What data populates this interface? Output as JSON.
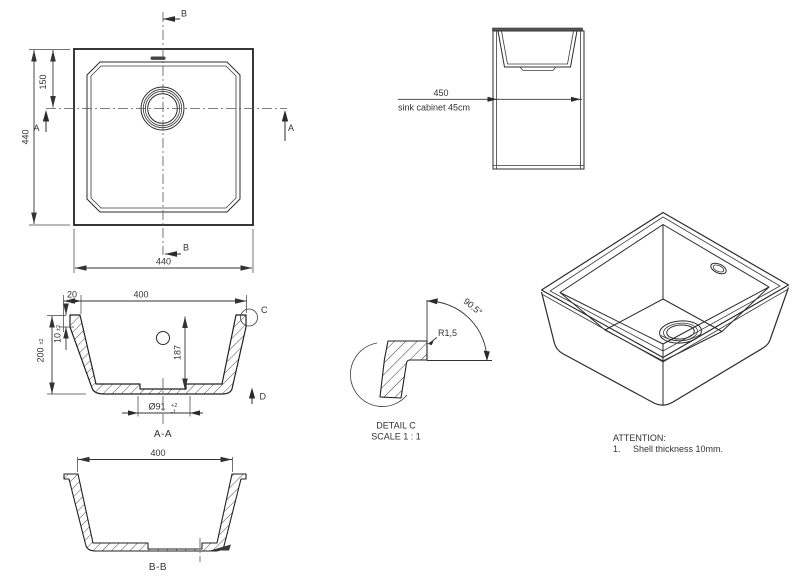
{
  "colors": {
    "line": "#2b2b2b",
    "text": "#333333",
    "background": "#ffffff"
  },
  "plan": {
    "dim_height": "440",
    "dim_drain_offset": "150",
    "dim_width": "440",
    "section_a": "A",
    "section_b": "B"
  },
  "cabinet": {
    "dim_width": "450",
    "caption": "sink cabinet 45cm"
  },
  "section_aa": {
    "label": "A-A",
    "dim_rim": "20",
    "dim_opening": "400",
    "dim_step": "10",
    "dim_step_tol": "±2",
    "dim_depth": "200",
    "dim_depth_tol": "±2",
    "dim_inner_depth": "187",
    "dim_drain": "Ø91",
    "dim_drain_tol_plus": "+2",
    "dim_drain_tol_minus": "-1",
    "detail_ref": "C",
    "view_ref": "D"
  },
  "detail_c": {
    "radius": "R1,5",
    "angle": "90.5°",
    "title": "DETAIL C",
    "scale": "SCALE 1 : 1"
  },
  "section_bb": {
    "label": "B-B",
    "dim_width": "400"
  },
  "attention": {
    "title": "ATTENTION:",
    "item_number": "1.",
    "item_text": "Shell thickness 10mm."
  }
}
